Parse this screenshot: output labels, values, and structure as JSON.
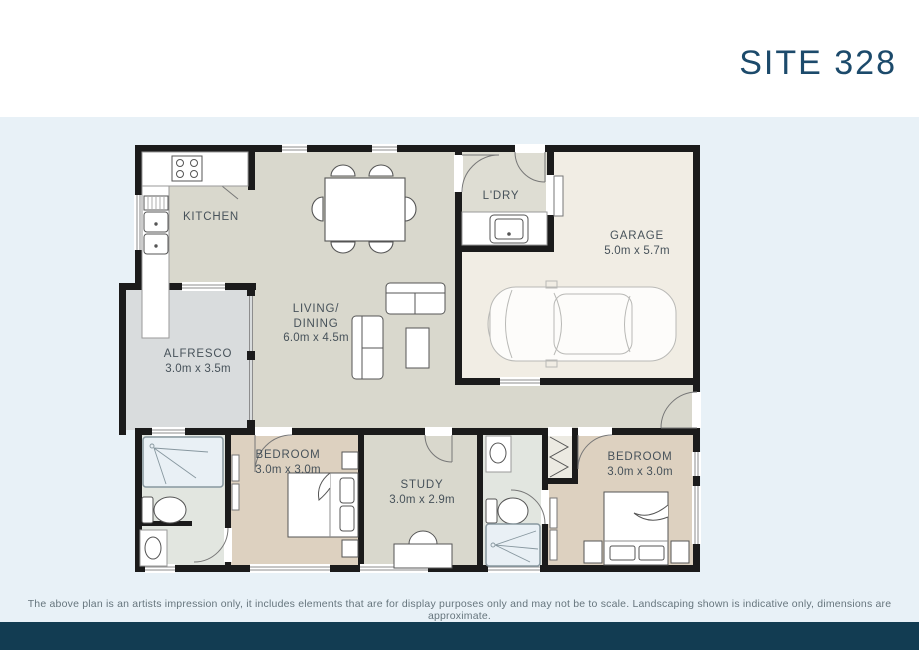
{
  "header": {
    "title": "SITE 328"
  },
  "rooms": {
    "kitchen": {
      "name": "KITCHEN"
    },
    "laundry": {
      "name": "L'DRY"
    },
    "garage": {
      "name": "GARAGE",
      "dims": "5.0m x 5.7m"
    },
    "living": {
      "name1": "LIVING/",
      "name2": "DINING",
      "dims": "6.0m x 4.5m"
    },
    "alfresco": {
      "name": "ALFRESCO",
      "dims": "3.0m x 3.5m"
    },
    "bedroom1": {
      "name": "BEDROOM",
      "dims": "3.0m x 3.0m"
    },
    "study": {
      "name": "STUDY",
      "dims": "3.0m x 2.9m"
    },
    "bedroom2": {
      "name": "BEDROOM",
      "dims": "3.0m x 3.0m"
    }
  },
  "footer": {
    "disclaimer": "The above plan is an artists impression only, it includes elements that are for display purposes only and may not be to scale. Landscaping shown is indicative only, dimensions are approximate."
  },
  "colors": {
    "page_background": "#e8f1f7",
    "header_background": "#ffffff",
    "title_text": "#1c4a6b",
    "label_text": "#47525a",
    "wall": "#1b1b1b",
    "floor_living": "#d9d8cd",
    "floor_laundry": "#deddd3",
    "floor_garage": "#f1ede4",
    "floor_alfresco": "#d9dcdd",
    "floor_bedroom": "#ddd1c0",
    "floor_bath": "#e2e6e0",
    "shower_fill": "#e9f0f5",
    "footer_bar": "#123c52"
  }
}
